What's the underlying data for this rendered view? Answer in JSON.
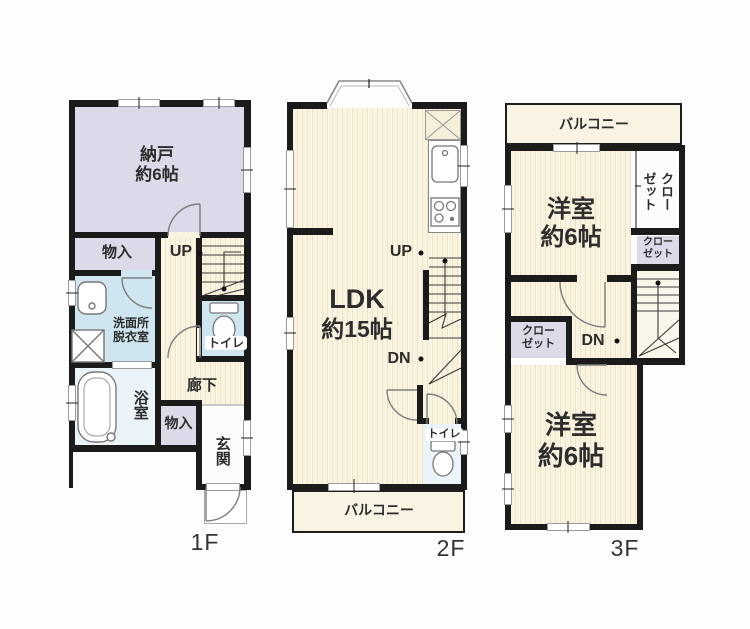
{
  "floors": {
    "f1": {
      "floor_label": "1F",
      "storage_room": {
        "name": "納戸",
        "size": "約6帖"
      },
      "closet_upper": "物入",
      "stairs_up": "UP",
      "washroom": {
        "line1": "洗面所",
        "line2": "脱衣室"
      },
      "toilet": "トイレ",
      "hallway": "廊下",
      "bathroom": "浴室",
      "closet_lower": "物入",
      "entrance": "玄関"
    },
    "f2": {
      "floor_label": "2F",
      "ldk": {
        "name": "LDK",
        "size": "約15帖"
      },
      "stairs_up": "UP",
      "stairs_down": "DN",
      "toilet": "トイレ",
      "balcony": "バルコニー"
    },
    "f3": {
      "floor_label": "3F",
      "balcony": "バルコニー",
      "bedroom_upper": {
        "name": "洋室",
        "size": "約6帖"
      },
      "closet_right": {
        "line1": "クロー",
        "line2": "ゼット"
      },
      "closet_middle": {
        "line1": "クロー",
        "line2": "ゼット"
      },
      "closet_left": {
        "line1": "クロー",
        "line2": "ゼット"
      },
      "stairs_down": "DN",
      "bedroom_lower": {
        "name": "洋室",
        "size": "約6帖"
      }
    }
  }
}
